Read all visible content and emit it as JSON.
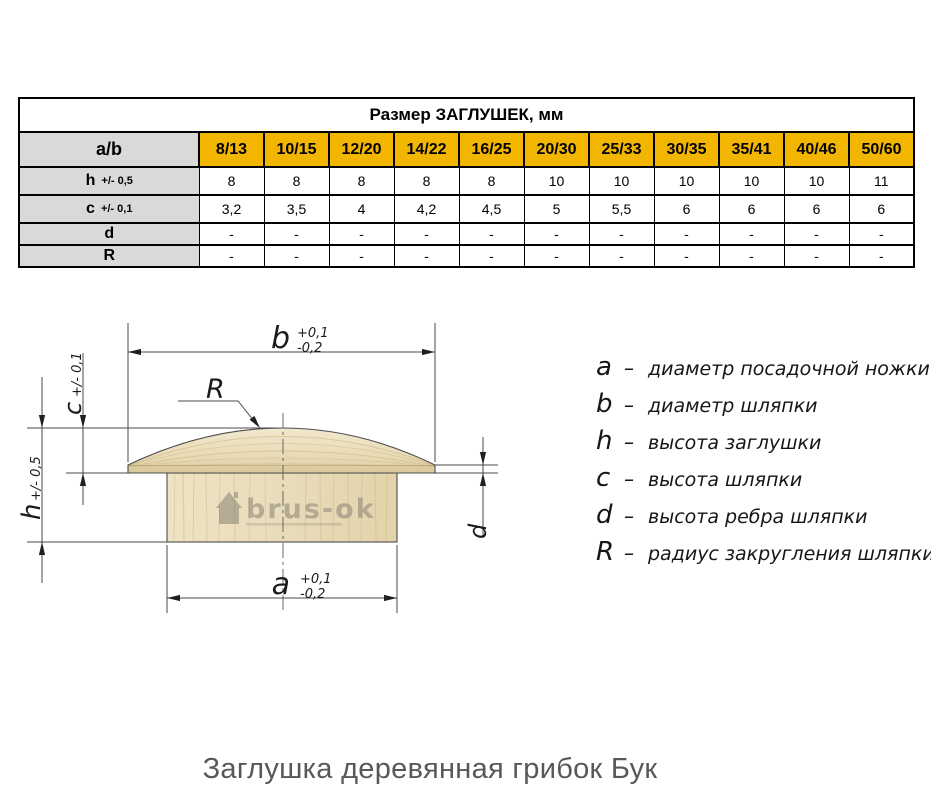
{
  "page": {
    "caption": "Заглушка деревянная грибок Бук"
  },
  "colors": {
    "header_yellow": "#f2b600",
    "label_gray": "#d9d9d9",
    "wood_light": "#ead9b0",
    "caption_gray": "#58585a"
  },
  "table": {
    "title": "Размер ЗАГЛУШЕК, мм",
    "corner_label": "a/b",
    "sizes": [
      "8/13",
      "10/15",
      "12/20",
      "14/22",
      "16/25",
      "20/30",
      "25/33",
      "30/35",
      "35/41",
      "40/46",
      "50/60"
    ],
    "rows": [
      {
        "label": "h",
        "tolerance": "+/- 0,5",
        "values": [
          "8",
          "8",
          "8",
          "8",
          "8",
          "10",
          "10",
          "10",
          "10",
          "10",
          "11"
        ]
      },
      {
        "label": "c",
        "tolerance": "+/- 0,1",
        "values": [
          "3,2",
          "3,5",
          "4",
          "4,2",
          "4,5",
          "5",
          "5,5",
          "6",
          "6",
          "6",
          "6"
        ]
      },
      {
        "label": "d",
        "tolerance": "",
        "values": [
          "-",
          "-",
          "-",
          "-",
          "-",
          "-",
          "-",
          "-",
          "-",
          "-",
          "-"
        ]
      },
      {
        "label": "R",
        "tolerance": "",
        "values": [
          "-",
          "-",
          "-",
          "-",
          "-",
          "-",
          "-",
          "-",
          "-",
          "-",
          "-"
        ]
      }
    ]
  },
  "drawing": {
    "dim_b": {
      "letter": "b",
      "tol_plus": "+0,1",
      "tol_minus": "-0,2"
    },
    "dim_a": {
      "letter": "a",
      "tol_plus": "+0,1",
      "tol_minus": "-0,2"
    },
    "dim_c": {
      "letter": "c",
      "tolerance": "+/- 0,1"
    },
    "dim_h": {
      "letter": "h",
      "tolerance": "+/- 0,5"
    },
    "dim_d": {
      "letter": "d"
    },
    "dim_r": {
      "letter": "R"
    },
    "watermark": "brus-ok"
  },
  "legend": {
    "dash": "–",
    "items": [
      {
        "symbol": "a",
        "text": "диаметр посадочной ножки"
      },
      {
        "symbol": "b",
        "text": "диаметр шляпки"
      },
      {
        "symbol": "h",
        "text": "высота заглушки"
      },
      {
        "symbol": "c",
        "text": "высота шляпки"
      },
      {
        "symbol": "d",
        "text": "высота ребра шляпки"
      },
      {
        "symbol": "R",
        "text": "радиус закругления шляпки"
      }
    ]
  }
}
